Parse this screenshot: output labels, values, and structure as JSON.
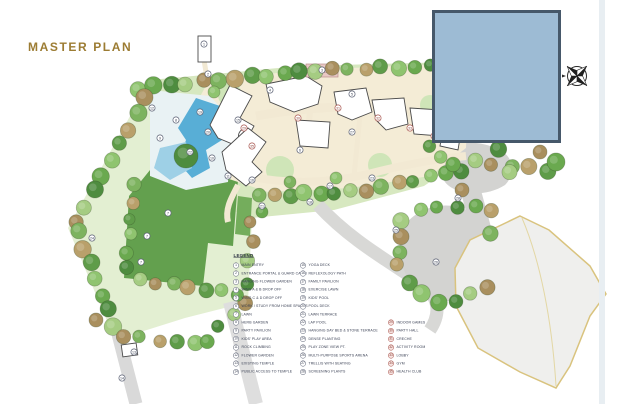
{
  "title": "MASTER PLAN",
  "colors": {
    "title": "#9c7c33",
    "masked_region_fill": "#9dbbd4",
    "masked_region_border": "#46586a",
    "legend_text": "#3a4054",
    "amenity_marker": "#a8554e",
    "lawn_green": "#63a04e",
    "pool_blue": "#58aed6",
    "path_cream": "#f3ead2"
  },
  "legend": {
    "heading": "LEGEND",
    "columns": [
      {
        "items": [
          {
            "num": "1",
            "label": "MAIN ENTRY"
          },
          {
            "num": "2",
            "label": "ENTRANCE PORTAL & GUARD CABIN"
          },
          {
            "num": "3",
            "label": "HANGING FLOWER GARDEN"
          },
          {
            "num": "4",
            "label": "WING A & B DROP OFF"
          },
          {
            "num": "5",
            "label": "WING C & D DROP OFF"
          },
          {
            "num": "6",
            "label": "WORK / STUDY FROM HOME SPACES"
          },
          {
            "num": "7",
            "label": "LAWN"
          },
          {
            "num": "8",
            "label": "HERB GARDEN"
          },
          {
            "num": "9",
            "label": "PARTY PAVILION"
          },
          {
            "num": "10",
            "label": "KIDS' PLAY AREA"
          },
          {
            "num": "11",
            "label": "ROCK CLIMBING"
          },
          {
            "num": "12",
            "label": "FLOWER GARDEN"
          },
          {
            "num": "13",
            "label": "EXISTING TEMPLE"
          },
          {
            "num": "14",
            "label": "PUBLIC ACCESS TO TEMPLE"
          }
        ]
      },
      {
        "items": [
          {
            "num": "15",
            "label": "YOGA DECK"
          },
          {
            "num": "16",
            "label": "REFLEXOLOGY PATH"
          },
          {
            "num": "17",
            "label": "FAMILY PAVILION"
          },
          {
            "num": "18",
            "label": "EXERCISE LAWN"
          },
          {
            "num": "19",
            "label": "KIDS' POOL"
          },
          {
            "num": "20",
            "label": "POOL DECK"
          },
          {
            "num": "21",
            "label": "LAWN TERRACE"
          },
          {
            "num": "22",
            "label": "LAP POOL"
          },
          {
            "num": "23",
            "label": "HANGING DAY BED & STONE TERRACE"
          },
          {
            "num": "24",
            "label": "DENSE PLANTING"
          },
          {
            "num": "25",
            "label": "PLAY ZONE VIEW PT."
          },
          {
            "num": "26",
            "label": "MULTI-PURPOSE SPORTS ARENA"
          },
          {
            "num": "27",
            "label": "TRELLIS WITH SEATING"
          },
          {
            "num": "28",
            "label": "SCREENING PLANTS"
          }
        ]
      },
      {
        "items": [
          {
            "num": "29",
            "label": "INDOOR GAMES"
          },
          {
            "num": "30",
            "label": "PARTY HALL"
          },
          {
            "num": "31",
            "label": "CRECHE"
          },
          {
            "num": "32",
            "label": "ACTIVITY ROOM"
          },
          {
            "num": "33",
            "label": "LOBBY"
          },
          {
            "num": "34",
            "label": "GYM"
          },
          {
            "num": "35",
            "label": "HEALTH CLUB"
          }
        ]
      }
    ]
  },
  "map": {
    "markers": [
      {
        "n": "1",
        "x": 204,
        "y": 44
      },
      {
        "n": "2",
        "x": 208,
        "y": 74
      },
      {
        "n": "3",
        "x": 322,
        "y": 70
      },
      {
        "n": "4",
        "x": 270,
        "y": 90
      },
      {
        "n": "5",
        "x": 352,
        "y": 94
      },
      {
        "n": "6",
        "x": 300,
        "y": 150
      },
      {
        "n": "7",
        "x": 168,
        "y": 213
      },
      {
        "n": "7",
        "x": 147,
        "y": 236
      },
      {
        "n": "7",
        "x": 141,
        "y": 262
      },
      {
        "n": "8",
        "x": 176,
        "y": 120
      },
      {
        "n": "9",
        "x": 160,
        "y": 138
      },
      {
        "n": "10",
        "x": 212,
        "y": 158
      },
      {
        "n": "11",
        "x": 228,
        "y": 176
      },
      {
        "n": "12",
        "x": 152,
        "y": 108
      },
      {
        "n": "13",
        "x": 134,
        "y": 352
      },
      {
        "n": "14",
        "x": 122,
        "y": 378
      },
      {
        "n": "15",
        "x": 238,
        "y": 120
      },
      {
        "n": "16",
        "x": 252,
        "y": 180
      },
      {
        "n": "17",
        "x": 330,
        "y": 186
      },
      {
        "n": "18",
        "x": 310,
        "y": 202
      },
      {
        "n": "19",
        "x": 200,
        "y": 112
      },
      {
        "n": "20",
        "x": 208,
        "y": 132
      },
      {
        "n": "21",
        "x": 262,
        "y": 206
      },
      {
        "n": "22",
        "x": 190,
        "y": 152
      },
      {
        "n": "23",
        "x": 372,
        "y": 178
      },
      {
        "n": "24",
        "x": 92,
        "y": 238
      },
      {
        "n": "25",
        "x": 396,
        "y": 230
      },
      {
        "n": "26",
        "x": 436,
        "y": 262
      },
      {
        "n": "27",
        "x": 352,
        "y": 132
      },
      {
        "n": "28",
        "x": 458,
        "y": 198
      },
      {
        "n": "29",
        "x": 244,
        "y": 128,
        "t": "a"
      },
      {
        "n": "30",
        "x": 298,
        "y": 118,
        "t": "a"
      },
      {
        "n": "31",
        "x": 338,
        "y": 108,
        "t": "a"
      },
      {
        "n": "32",
        "x": 378,
        "y": 118,
        "t": "a"
      },
      {
        "n": "33",
        "x": 410,
        "y": 128,
        "t": "a"
      },
      {
        "n": "34",
        "x": 434,
        "y": 136,
        "t": "a"
      },
      {
        "n": "35",
        "x": 252,
        "y": 146,
        "t": "a"
      }
    ]
  }
}
